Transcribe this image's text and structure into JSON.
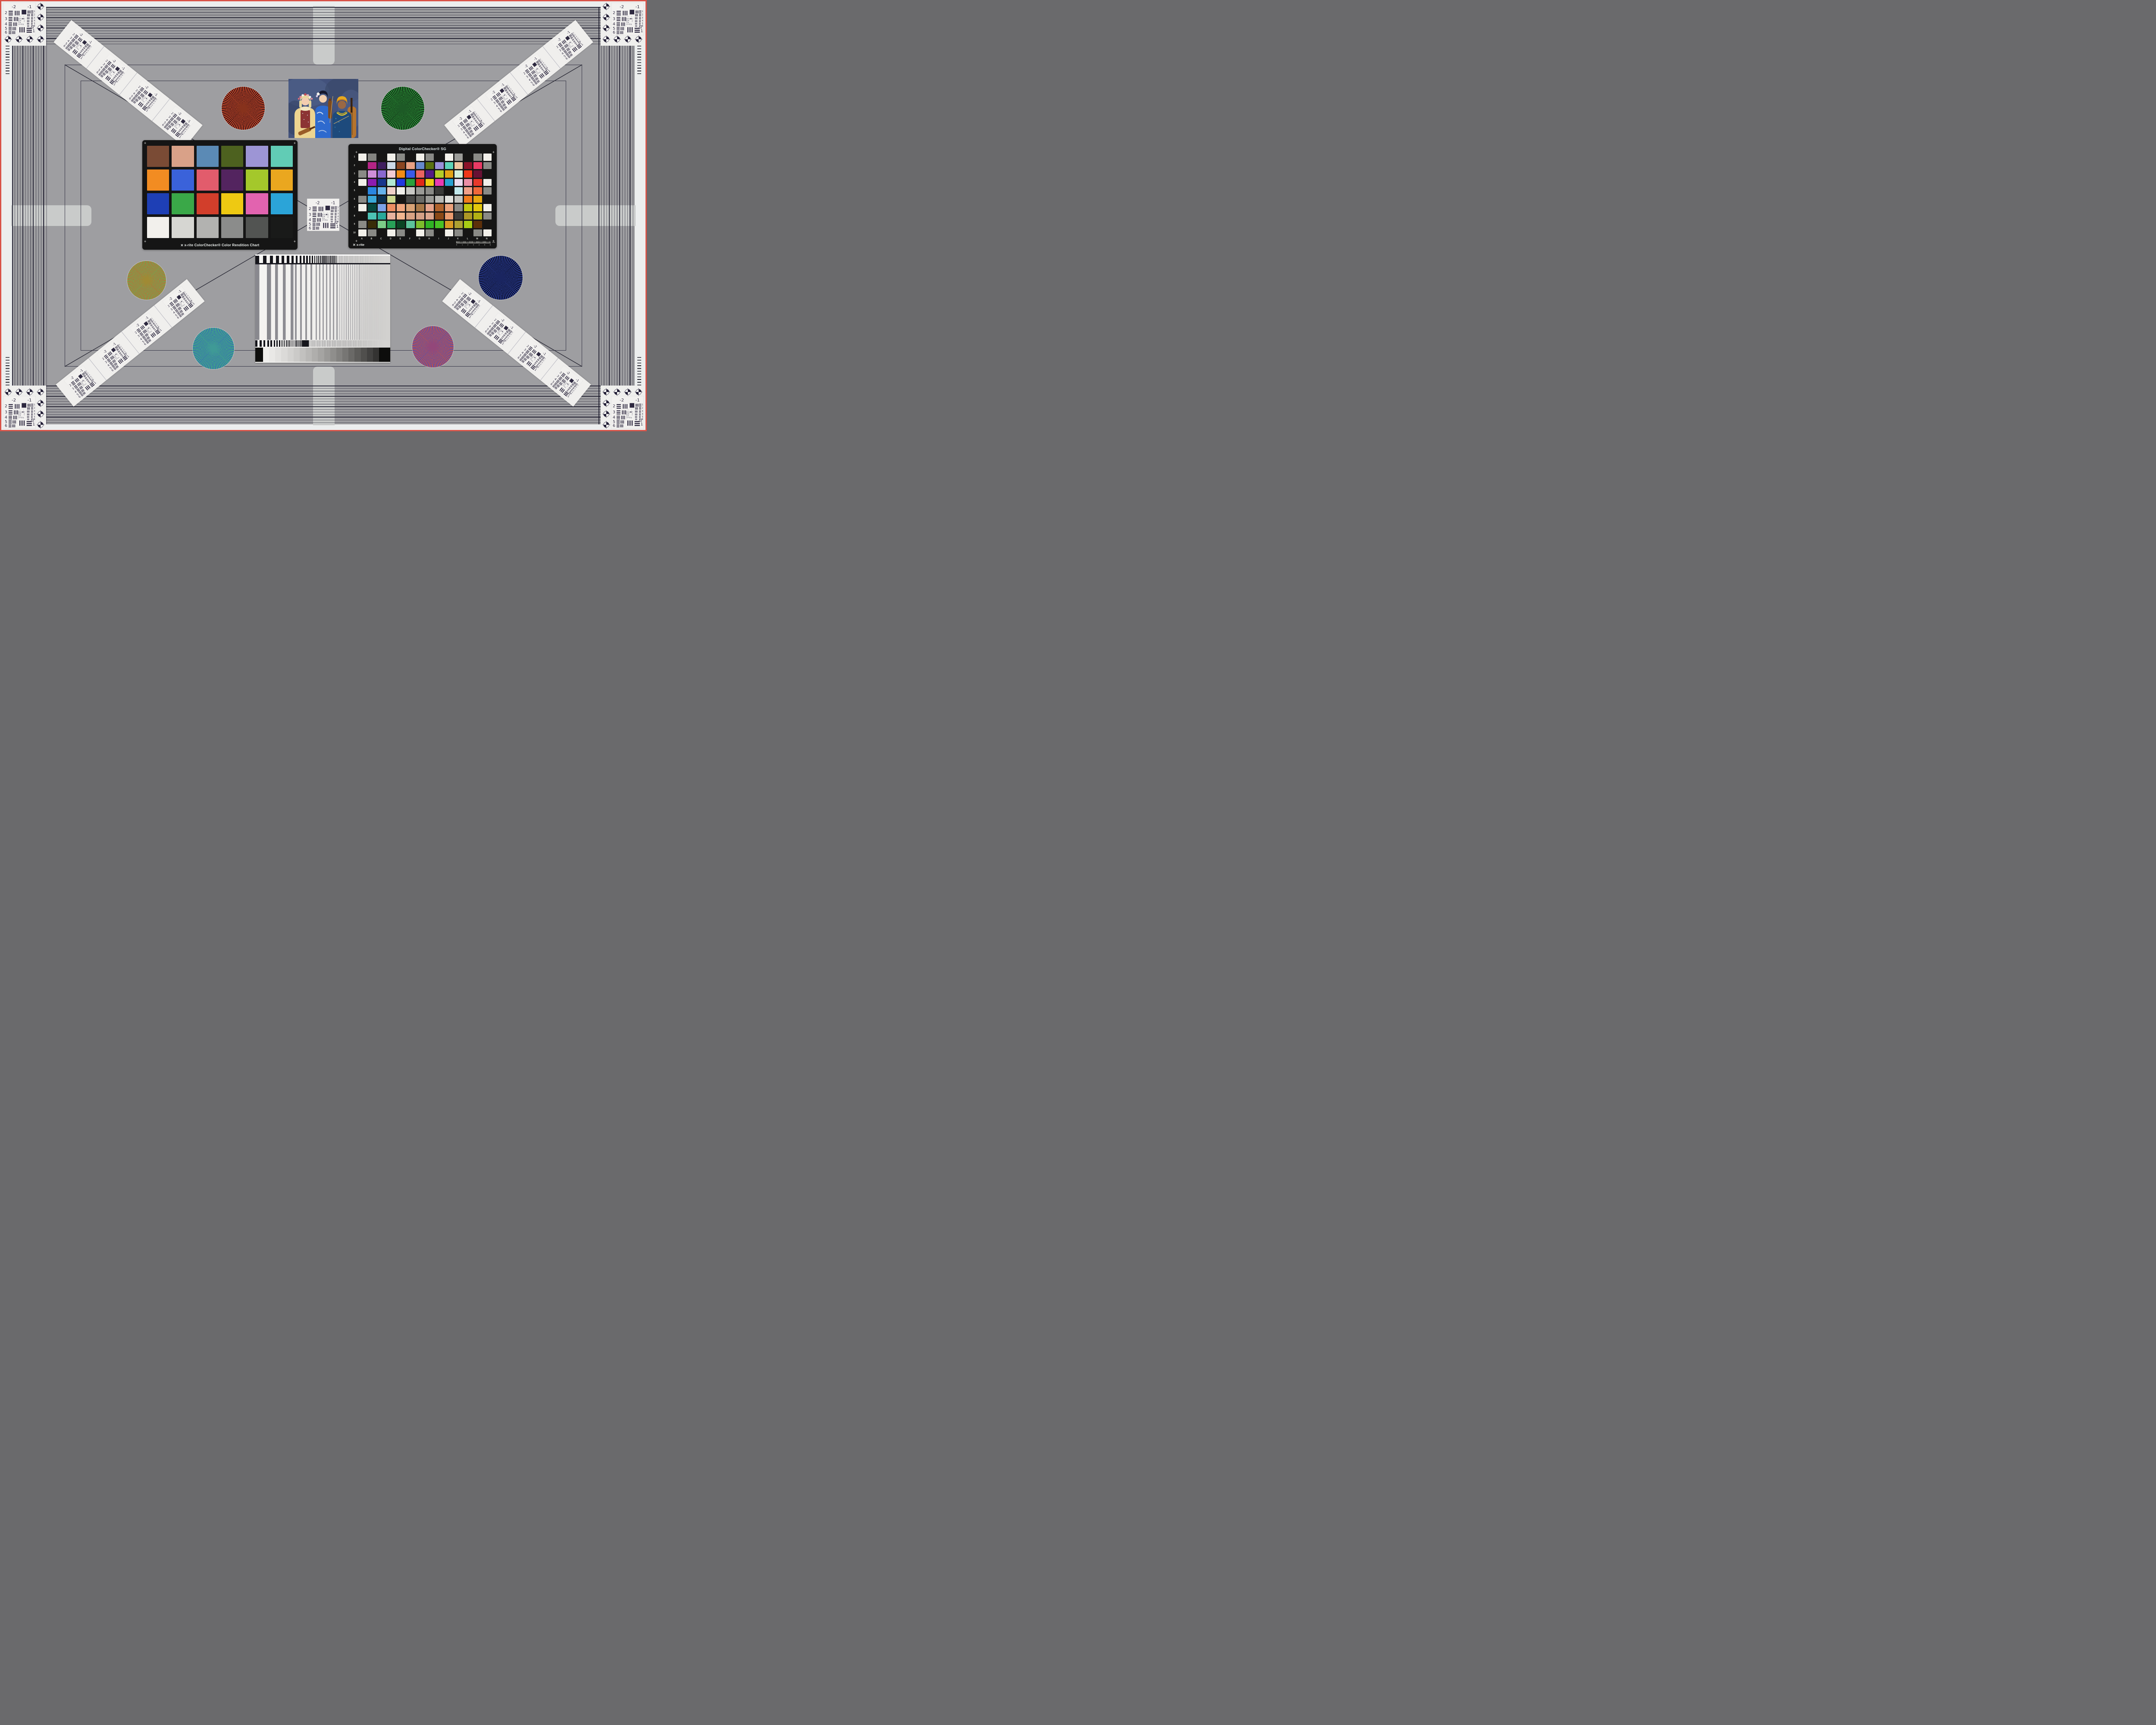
{
  "palette": {
    "bg": "#9e9ea1",
    "outer_white": "#eceeee",
    "frame_red": "#d95348",
    "light_bar": "#c9cbca",
    "chart_black": "#151515",
    "bar_ink": "#15151b",
    "usaf_ink": "#2e2940"
  },
  "colorchecker": {
    "logo_glyph": "✕",
    "title": "x-rite ColorChecker® Color Rendition Chart",
    "patches": [
      "#7a4b35",
      "#d9a188",
      "#5b8ab5",
      "#4d611f",
      "#9d95d5",
      "#61ccb5",
      "#f28c22",
      "#3a62da",
      "#e25c6c",
      "#53245f",
      "#a4c82b",
      "#eaa71f",
      "#1e3fb5",
      "#3aa848",
      "#d23e2b",
      "#eec912",
      "#e263af",
      "#2ba4d8",
      "#f2f0ec",
      "#d6d6d2",
      "#b2b2b0",
      "#8b8c8b",
      "#525452",
      "#191a19"
    ]
  },
  "sg": {
    "title": "Digital ColorChecker® SG",
    "brand": "x-rite",
    "brand_glyph": "✕",
    "row_labels": [
      "1",
      "2",
      "3",
      "4",
      "5",
      "6",
      "7",
      "8",
      "9",
      "10"
    ],
    "col_labels": [
      "A",
      "B",
      "C",
      "D",
      "E",
      "F",
      "G",
      "H",
      "I",
      "J",
      "K",
      "L",
      "M",
      "N"
    ],
    "ruler": {
      "unit": "mm",
      "ticks": [
        "0",
        "1",
        "2",
        "3",
        "4",
        "5",
        "6"
      ]
    },
    "patches": [
      [
        "#f2f0ea",
        "#848480",
        "#161514",
        "#f2f0ea",
        "#8a8a86",
        "#161514",
        "#f2f0ea",
        "#8a8a86",
        "#161514",
        "#f4f2ec",
        "#9c9c98",
        "#161514",
        "#8a8a86",
        "#f2f0ea"
      ],
      [
        "#161514",
        "#b52486",
        "#3f1f5f",
        "#ccd9e8",
        "#8a4520",
        "#e8a183",
        "#6688cc",
        "#5a7210",
        "#9a90d8",
        "#5ed3b8",
        "#f0c5a2",
        "#8c1228",
        "#e83a64",
        "#8a8a86"
      ],
      [
        "#8a8a86",
        "#cf8ed8",
        "#8a68cf",
        "#f2ccd4",
        "#f28c16",
        "#3a5ae8",
        "#ea6360",
        "#551a86",
        "#b3cc28",
        "#e2a416",
        "#d5f0da",
        "#f0381a",
        "#681034",
        "#161514"
      ],
      [
        "#f2f0ea",
        "#8c1cb0",
        "#17368c",
        "#b2e8d4",
        "#2038e0",
        "#2aa03c",
        "#e02818",
        "#eccb12",
        "#e83ab2",
        "#28a0d0",
        "#eadcf0",
        "#ec8ea6",
        "#e8392c",
        "#f2f0ea"
      ],
      [
        "#161514",
        "#2a86e0",
        "#66b2ea",
        "#f0d0c8",
        "#f0efea",
        "#c8c8c4",
        "#9a9a96",
        "#8a8a86",
        "#3a3a38",
        "#161514",
        "#c2e8ec",
        "#f0a088",
        "#f0683a",
        "#8a8a86"
      ],
      [
        "#8a8a86",
        "#3aa8d8",
        "#0c3050",
        "#ccd88e",
        "#161514",
        "#4a4a48",
        "#6a6a66",
        "#9a9a96",
        "#b8b8b4",
        "#e2e2de",
        "#c4c4c0",
        "#f07c1c",
        "#e8a810",
        "#161514"
      ],
      [
        "#f2f0ea",
        "#064840",
        "#7ca2e8",
        "#ee8e62",
        "#f0a67e",
        "#d8a276",
        "#a87848",
        "#e6a48c",
        "#b0622c",
        "#eca27c",
        "#8a8a86",
        "#c2c80e",
        "#e4c80c",
        "#f2f0ea"
      ],
      [
        "#161514",
        "#4cc2b4",
        "#28a89a",
        "#e8b29e",
        "#f2b690",
        "#d8a284",
        "#d4a086",
        "#dca68e",
        "#8a4816",
        "#ea9c70",
        "#3c3c3a",
        "#ac9826",
        "#b2b014",
        "#8a8a86"
      ],
      [
        "#8a8a86",
        "#382c08",
        "#7ccc88",
        "#28a058",
        "#0a4424",
        "#5cc29a",
        "#7cbc2c",
        "#30b224",
        "#48c224",
        "#d89a24",
        "#aca032",
        "#a8cc14",
        "#5c300a",
        "#161514"
      ],
      [
        "#f2f0ea",
        "#8a8a86",
        "#161514",
        "#f2f0ea",
        "#8a8a86",
        "#161514",
        "#f2f0ea",
        "#8a8a86",
        "#161514",
        "#f2f0ea",
        "#8a8a86",
        "#161514",
        "#8a8a86",
        "#f2f0ea"
      ]
    ]
  },
  "usaf": {
    "top": [
      "-2",
      "-1"
    ],
    "left": [
      "2",
      "3",
      "4",
      "5",
      "6"
    ],
    "right": [
      "1",
      "2",
      "3",
      "4",
      "5",
      "6"
    ],
    "corner": [
      "-2",
      "1"
    ],
    "micro": [
      "0",
      "1"
    ]
  },
  "stars": [
    {
      "name": "red-black-star",
      "a": "#d84e2a",
      "b": "#2a0f14",
      "blend": "#87321c"
    },
    {
      "name": "green-black-star",
      "a": "#2fa23c",
      "b": "#0c1a10",
      "blend": "#1d5a26"
    },
    {
      "name": "red-green-star",
      "a": "#e0512b",
      "b": "#49c65c",
      "blend": "#a08a34"
    },
    {
      "name": "blue-black-star",
      "a": "#2b3f9e",
      "b": "#0a0c1e",
      "blend": "#1a2560"
    },
    {
      "name": "green-blue-star",
      "a": "#45c46a",
      "b": "#3458c8",
      "blend": "#3f9a96"
    },
    {
      "name": "red-blue-star",
      "a": "#e0512b",
      "b": "#3b50c8",
      "blend": "#93477a"
    }
  ],
  "bottom_chart": {
    "wedge_cap": "#0d0d0c",
    "wedge_steps": [
      "#efeeec",
      "#e9e8e6",
      "#e2e1df",
      "#dbdad8",
      "#d3d2d0",
      "#cbcac8",
      "#c2c1bf",
      "#b9b8b6",
      "#afaeac",
      "#a5a4a2",
      "#9a9997",
      "#8f8e8c",
      "#838280",
      "#777674",
      "#6a6967",
      "#5d5c5a",
      "#504f4d",
      "#424140",
      "#343332"
    ]
  }
}
